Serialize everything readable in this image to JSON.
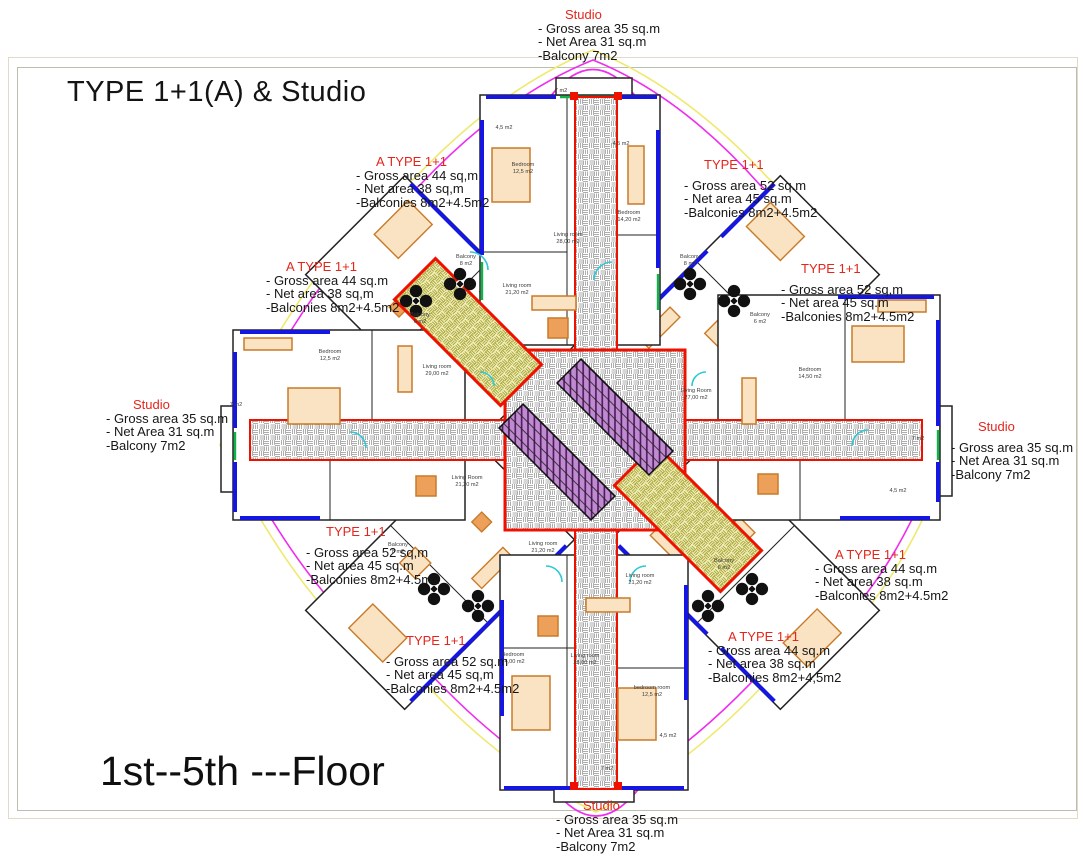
{
  "title": "TYPE 1+1(A) & Studio",
  "floor_label": "1st--5th ---Floor",
  "colors": {
    "label_red": "#e3261c",
    "core_red": "#ee1100",
    "wall_blue": "#1616e2",
    "boundary_magenta": "#f02cf0",
    "boundary_yellow": "#efe96e",
    "door_cyan": "#2fc6d6",
    "window_green": "#12b24a",
    "furniture_orange": "#c97a28",
    "hatch_gray": "#adadad"
  },
  "units": [
    {
      "id": "studio-top",
      "name": "Studio",
      "lines": [
        "- Gross area 35 sq.m",
        "- Net Area 31 sq.m",
        "-Balcony 7m2"
      ]
    },
    {
      "id": "a-type-top-left",
      "name": "A TYPE 1+1",
      "lines": [
        "- Gross area 44 sq,m",
        "- Net area 38 sq,m",
        "-Balconies 8m2+4.5m2"
      ]
    },
    {
      "id": "type-top-right",
      "name": "TYPE 1+1",
      "lines": [
        "- Gross area 52 sq.m",
        "- Net area 45 sq.m",
        "-Balconies 8m2+4.5m2"
      ]
    },
    {
      "id": "a-type-left",
      "name": "A TYPE 1+1",
      "lines": [
        "- Gross area 44 sq.m",
        "- Net area 38 sq,m",
        "-Balconies 8m2+4.5m2"
      ]
    },
    {
      "id": "type-right",
      "name": "TYPE 1+1",
      "lines": [
        "- Gross area 52 sq,m",
        "- Net area 45 sq.m",
        "-Balconies 8m2+4.5m2"
      ]
    },
    {
      "id": "studio-left",
      "name": "Studio",
      "lines": [
        "- Gross area 35 sq.m",
        "- Net Area 31 sq.m",
        "-Balcony 7m2"
      ]
    },
    {
      "id": "studio-right",
      "name": "Studio",
      "lines": [
        "- Gross area 35 sq.m",
        "- Net Area 31 sq.m",
        "-Balcony 7m2"
      ]
    },
    {
      "id": "type-mid-left",
      "name": "TYPE 1+1",
      "lines": [
        "- Gross area 52 sq,m",
        "- Net area 45 sq.m",
        "-Balconies 8m2+4.5m2"
      ]
    },
    {
      "id": "a-type-right",
      "name": "A TYPE 1+1",
      "lines": [
        "- Gross area 44 sq.m",
        "- Net area 38 sq.m",
        "-Balconies 8m2+4.5m2"
      ]
    },
    {
      "id": "type-bottom-left",
      "name": "TYPE 1+1",
      "lines": [
        "- Gross area 52 sq.m",
        "- Net area 45 sq,m",
        "-Balconies 8m2+4.5m2"
      ]
    },
    {
      "id": "a-type-bottom-right",
      "name": "A TYPE 1+1",
      "lines": [
        "- Gross area 44 sq.m",
        "- Net area 38 sq.m",
        "-Balconies 8m2+4,5m2"
      ]
    },
    {
      "id": "studio-bottom",
      "name": "Studio",
      "lines": [
        "- Gross area 35 sq.m",
        "- Net Area 31 sq.m",
        "-Balcony 7m2"
      ]
    }
  ],
  "plan": {
    "rooms": [
      {
        "name": "Bedroom",
        "area": "12,5 m2"
      },
      {
        "name": "Bedroom",
        "area": "14,20 m2"
      },
      {
        "name": "Living room",
        "area": "28,00 m2"
      },
      {
        "name": "Living room",
        "area": "21,20 m2"
      },
      {
        "name": "Living Room",
        "area": "27,00 m2"
      },
      {
        "name": "Living Room",
        "area": "21,20 m2"
      },
      {
        "name": "Living room",
        "area": "21,20 m2"
      },
      {
        "name": "Bedroom",
        "area": "14,00 m2"
      },
      {
        "name": "Living room",
        "area": "28,00 m2"
      },
      {
        "name": "bedroom room",
        "area": "12,5 m2"
      },
      {
        "name": "Bedroom",
        "area": "14,50 m2"
      },
      {
        "name": "Bedroom",
        "area": "12,5 m2"
      },
      {
        "name": "Living room",
        "area": "29,00 m2"
      },
      {
        "name": "Living room",
        "area": "21,20 m2"
      }
    ],
    "balconies": [
      {
        "name": "Balcony",
        "area": "8 m2"
      },
      {
        "name": "Balcony",
        "area": "8 m2"
      },
      {
        "name": "Balcony",
        "area": "6 m2"
      },
      {
        "name": "Balcony",
        "area": "6 m2"
      },
      {
        "name": "Balcony",
        "area": "8 m2"
      },
      {
        "name": "Balcony",
        "area": "6 m2"
      }
    ],
    "dims": [
      {
        "label": "4,5 m2"
      },
      {
        "label": "7 m2"
      },
      {
        "label": "4,5 m2"
      },
      {
        "label": "7 m2"
      },
      {
        "label": "4,5 m2"
      },
      {
        "label": "7 m2"
      },
      {
        "label": "7 m2"
      },
      {
        "label": "4,5 m2"
      }
    ]
  }
}
